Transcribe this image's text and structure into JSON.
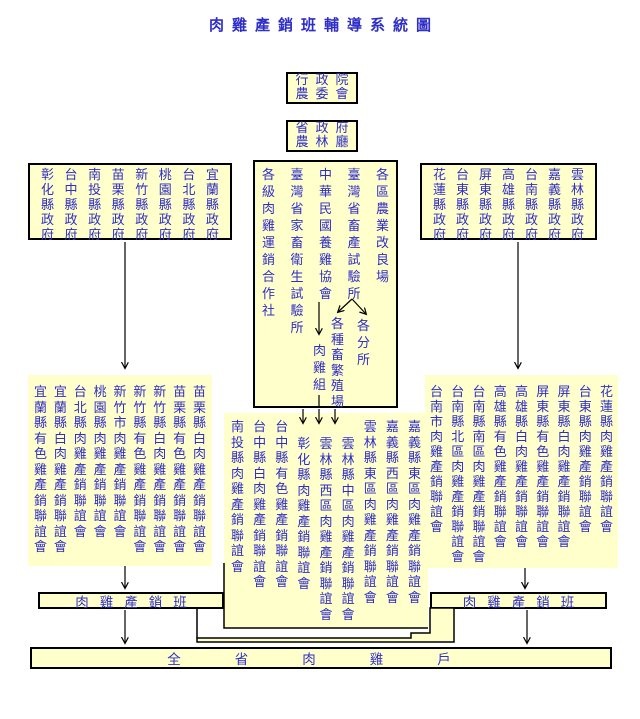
{
  "title": "肉雞產銷班輔導系統圖",
  "colors": {
    "background": "#FFFFFF",
    "box_fill": "#FFFFCC",
    "text_blue": "#2E2EC8",
    "line_black": "#000000"
  },
  "top_boxes": {
    "council": {
      "line1": "行政院",
      "line2": "農委會"
    },
    "province": {
      "line1": "省政府",
      "line2": "農林廳"
    }
  },
  "gov_left": {
    "columns": [
      "彰化縣政府",
      "台中縣政府",
      "南投縣政府",
      "苗栗縣政府",
      "新竹縣政府",
      "桃園縣政府",
      "台北縣政府",
      "宜蘭縣政府"
    ]
  },
  "gov_right": {
    "columns": [
      "花蓮縣政府",
      "台東縣政府",
      "屏東縣政府",
      "高雄縣政府",
      "台南縣政府",
      "嘉義縣政府",
      "雲林縣政府"
    ]
  },
  "center_orgs": {
    "columns": [
      "各級肉雞運銷合作社",
      "臺灣省家畜衛生試驗所",
      "中華民國養雞協會",
      "臺灣省畜產試驗所",
      "各區農業改良場"
    ],
    "broiler_section": "肉雞組",
    "breeding_stations": "各種畜繁殖場",
    "branch_offices": "各分所"
  },
  "group_left": {
    "columns": [
      "宜蘭縣有色雞產銷聯誼會",
      "宜蘭縣白肉雞產銷聯誼會",
      "台北縣肉雞產銷聯誼會",
      "桃園縣肉雞產銷聯誼會",
      "新竹市肉雞產銷聯誼會",
      "新竹縣有色雞產銷聯誼會",
      "新竹縣白肉雞產銷聯誼會",
      "苗栗縣有色雞產銷聯誼會",
      "苗栗縣白肉雞產銷聯誼會"
    ]
  },
  "group_center": {
    "columns": [
      "南投縣肉雞產銷聯誼會",
      "台中縣白肉雞產銷聯誼會",
      "台中縣有色雞產銷聯誼會",
      "彰化縣肉雞產銷聯誼會",
      "雲林縣西區肉雞產銷聯誼會",
      "雲林縣中區肉雞產銷聯誼會",
      "雲林縣東區肉雞產銷聯誼會",
      "嘉義縣西區肉雞產銷聯誼會",
      "嘉義縣東區肉雞產銷聯誼會"
    ]
  },
  "group_right": {
    "columns": [
      "台南市肉雞產銷聯誼會",
      "台南縣北區肉雞產銷聯誼會",
      "台南縣南區肉雞產銷聯誼會",
      "高雄縣有色雞產銷聯誼會",
      "高雄縣白肉雞產銷聯誼會",
      "屏東縣有色雞產銷聯誼會",
      "屏東縣白肉雞產銷聯誼會",
      "台東縣肉雞產銷聯誼會",
      "花蓮縣肉雞產銷聯誼會"
    ]
  },
  "class_boxes": {
    "left": "肉雞產銷班",
    "right": "肉雞產銷班"
  },
  "bottom_box": "全省肉雞戶"
}
